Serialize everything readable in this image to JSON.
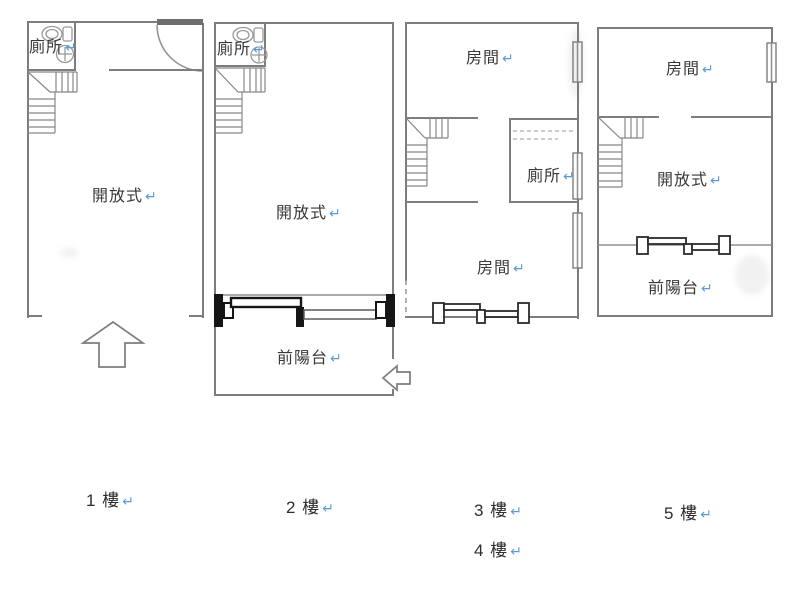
{
  "colors": {
    "wall_gray": "#7d7d7d",
    "window_frame_black": "#161616",
    "label_text": "#383838",
    "return_mark_blue": "#5b9bd5",
    "background": "#ffffff"
  },
  "return_mark": "↵",
  "floor_plans": [
    {
      "id": "floor-1",
      "labels": {
        "toilet": "廁所",
        "open_area": "開放式"
      }
    },
    {
      "id": "floor-2",
      "labels": {
        "toilet": "廁所",
        "open_area": "開放式",
        "front_balcony": "前陽台"
      }
    },
    {
      "id": "floor-3-4",
      "labels": {
        "room_top": "房間",
        "toilet": "廁所",
        "room_bottom": "房間"
      }
    },
    {
      "id": "floor-5",
      "labels": {
        "room_top": "房間",
        "open_area": "開放式",
        "front_balcony": "前陽台"
      }
    }
  ],
  "floor_captions": [
    {
      "label": "1 樓"
    },
    {
      "label": "2 樓"
    },
    {
      "label": "3 樓"
    },
    {
      "label": "4 樓"
    },
    {
      "label": "5 樓"
    }
  ]
}
